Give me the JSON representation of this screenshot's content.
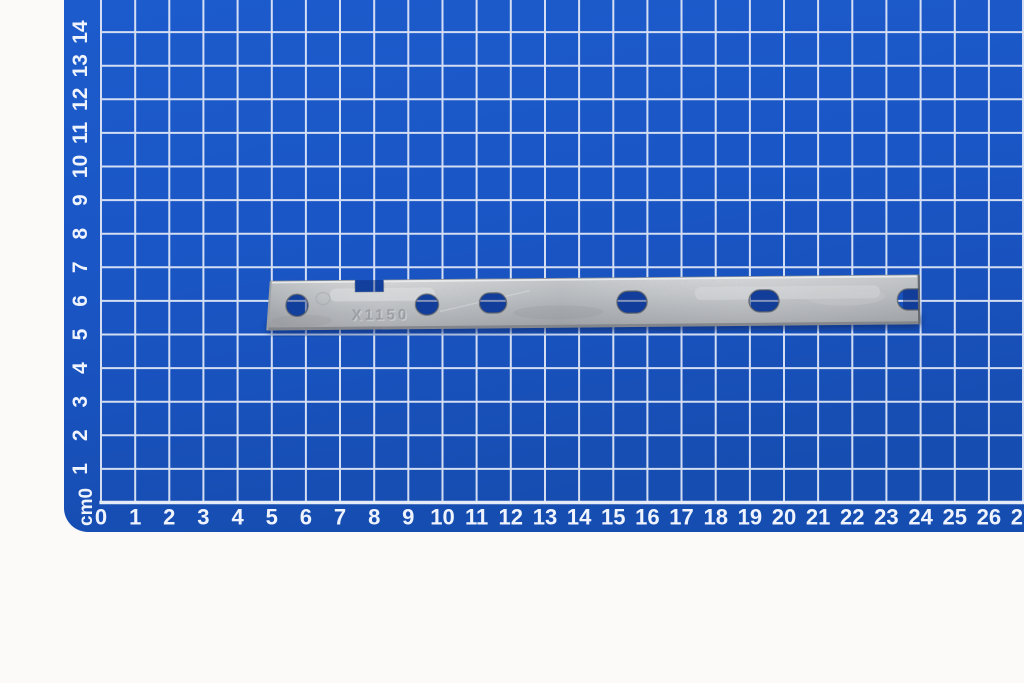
{
  "photo": {
    "width": 1024,
    "height": 683,
    "background_color": "#fbfaf8"
  },
  "cutting_mat": {
    "surface_color": "#1a55c4",
    "surface_color_light": "#1d5ccd",
    "surface_color_deep": "#164db1",
    "grid_line_color": "#e3eaf8",
    "ruler_text_color": "#eef3fd",
    "corner_unit_label": "cm0",
    "bottom_ruler_labels": [
      "0",
      "1",
      "2",
      "3",
      "4",
      "5",
      "6",
      "7",
      "8",
      "9",
      "10",
      "11",
      "12",
      "13",
      "14",
      "15",
      "16",
      "17",
      "18",
      "19",
      "20",
      "21",
      "22",
      "23",
      "24",
      "25",
      "26",
      "27"
    ],
    "left_ruler_labels": [
      "1",
      "2",
      "3",
      "4",
      "5",
      "6",
      "7",
      "8",
      "9",
      "10",
      "11",
      "12",
      "13",
      "14"
    ],
    "grid": {
      "origin_x": 101,
      "origin_y": 502.5,
      "cm_px_x": 34.15,
      "cm_px_y": 33.6,
      "columns": 28,
      "rows": 14,
      "mat_left_x": 64,
      "mat_bottom_y": 532,
      "corner_radius": 24
    }
  },
  "metal_strip": {
    "embossed_text": "X1150",
    "metal_light": "#d3d5d7",
    "metal_mid1": "#c2c5c8",
    "metal_mid2": "#b0b3b7",
    "metal_dark": "#9da0a4",
    "edge_dark": "#63666b",
    "hole_shadow_tint": "rgba(8,30,100,0.40)",
    "cast_shadow_color": "#0a2a6b",
    "body": {
      "left_top_x": 271,
      "left_bottom_x": 267,
      "right_x": 919,
      "top_y": 278,
      "bottom_y": 327,
      "rotation_deg": -0.55,
      "pivot_x": 594,
      "pivot_y": 302
    },
    "top_notch": {
      "x1": 355,
      "x2": 384,
      "bottom_y": 290
    },
    "holes": [
      {
        "shape": "round",
        "cx": 297,
        "cy": 302.5,
        "rx": 11,
        "ry": 11
      },
      {
        "shape": "round",
        "cx": 427,
        "cy": 303,
        "rx": 11.5,
        "ry": 10.5
      },
      {
        "shape": "oval",
        "cx": 493,
        "cy": 302,
        "rx": 13.5,
        "ry": 10
      },
      {
        "shape": "oval",
        "cx": 632,
        "cy": 302.5,
        "rx": 15,
        "ry": 11
      },
      {
        "shape": "oval",
        "cx": 764,
        "cy": 302.5,
        "rx": 15,
        "ry": 11
      }
    ],
    "end_slot": {
      "open_x": 919,
      "inner_x": 908,
      "cy": 302.5,
      "ry": 10.5
    }
  }
}
